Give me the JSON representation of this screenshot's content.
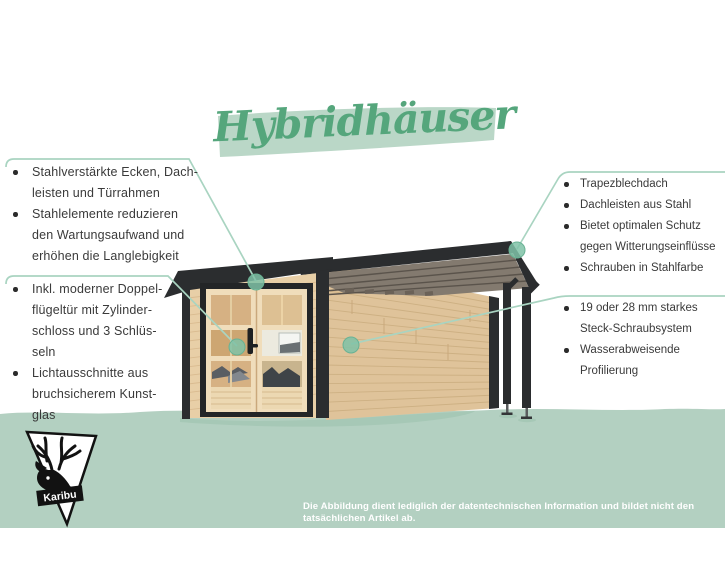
{
  "title": "Hybridhäuser",
  "feature_blocks": {
    "top_left": {
      "lines": [
        "Stahlverstärkte Ecken, Dach-",
        "leisten und Türrahmen",
        "Stahlelemente reduzieren",
        "den Wartungsaufwand und",
        "erhöhen die Langlebigkeit"
      ]
    },
    "bottom_left": {
      "lines": [
        "Inkl. moderner Doppel-",
        "flügeltür mit Zylinder-",
        "schloss und 3 Schlüs-",
        "seln",
        "Lichtausschnitte aus",
        "bruchsicherem Kunst-",
        "glas"
      ]
    },
    "top_right": {
      "lines": [
        "Trapezblechdach",
        "Dachleisten aus Stahl",
        "Bietet optimalen Schutz",
        "gegen Witterungseinflüsse",
        "Schrauben in Stahlfarbe"
      ]
    },
    "bottom_right": {
      "lines": [
        "19 oder 28 mm starkes",
        "Steck-Schraubsystem",
        "Wasserabweisende",
        "Profilierung"
      ]
    }
  },
  "callouts": {
    "top_left_target": "door-frame-top",
    "bottom_left_target": "door-glazing",
    "top_right_target": "canopy-roof-corner",
    "bottom_right_target": "side-wall"
  },
  "logo": {
    "label": "Karibu"
  },
  "disclaimer": "Die Abbildung dient lediglich der datentechnischen Information und bildet nicht den tatsächlichen Artikel ab.",
  "colors": {
    "title_green": "#55a67c",
    "title_highlight": "#bad7c7",
    "ground_green": "#b3d0c1",
    "callout_line": "#a9d4c1",
    "callout_dot": "#7fc2a7",
    "anthracite": "#2b2d2f",
    "wood_front": "#e8cfa7",
    "wood_side": "#dfc39a",
    "door_cream": "#f0ddbb",
    "text_gray": "#3a3a3a",
    "disclaimer_white": "#ffffff"
  },
  "illustration": {
    "subject": "garden house with steel elements and flat-roof side canopy"
  }
}
